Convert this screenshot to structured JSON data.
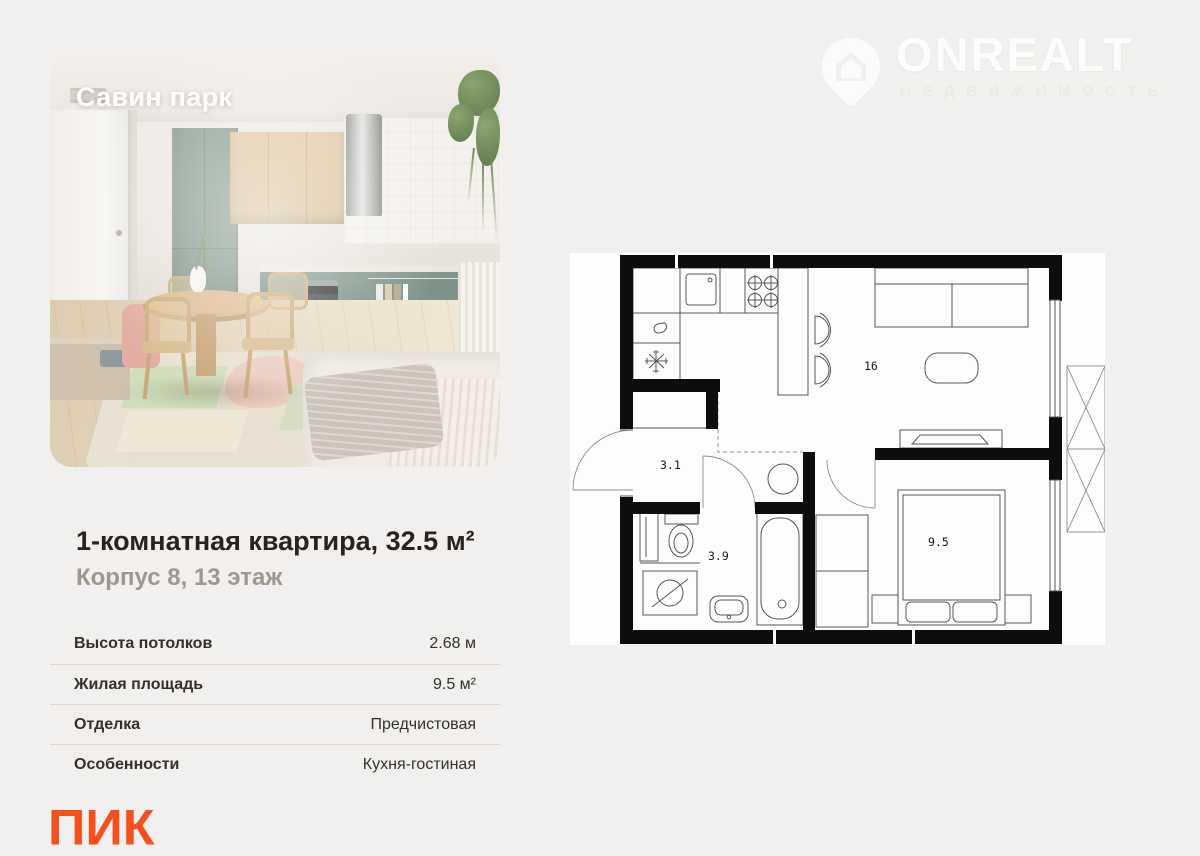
{
  "watermark": {
    "brand": "ONREALT",
    "subtitle": "НЕДВИЖИМОСТЬ"
  },
  "photo": {
    "project_name": "Савин парк"
  },
  "listing": {
    "title": "1-комнатная квартира, 32.5 м²",
    "subtitle": "Корпус 8, 13 этаж"
  },
  "details": {
    "rows": [
      {
        "label": "Высота потолков",
        "value": "2.68 м"
      },
      {
        "label": "Жилая площадь",
        "value": "9.5 м²"
      },
      {
        "label": "Отделка",
        "value": "Предчистовая"
      },
      {
        "label": "Особенности",
        "value": "Кухня-гостиная"
      }
    ]
  },
  "developer": {
    "logo_text": "ПИК",
    "brand_color": "#f4501e"
  },
  "floorplan": {
    "rooms": [
      {
        "name": "kitchen-living-room",
        "area_label": "16"
      },
      {
        "name": "hallway",
        "area_label": "3.1"
      },
      {
        "name": "bathroom",
        "area_label": "3.9"
      },
      {
        "name": "bedroom",
        "area_label": "9.5"
      }
    ]
  }
}
